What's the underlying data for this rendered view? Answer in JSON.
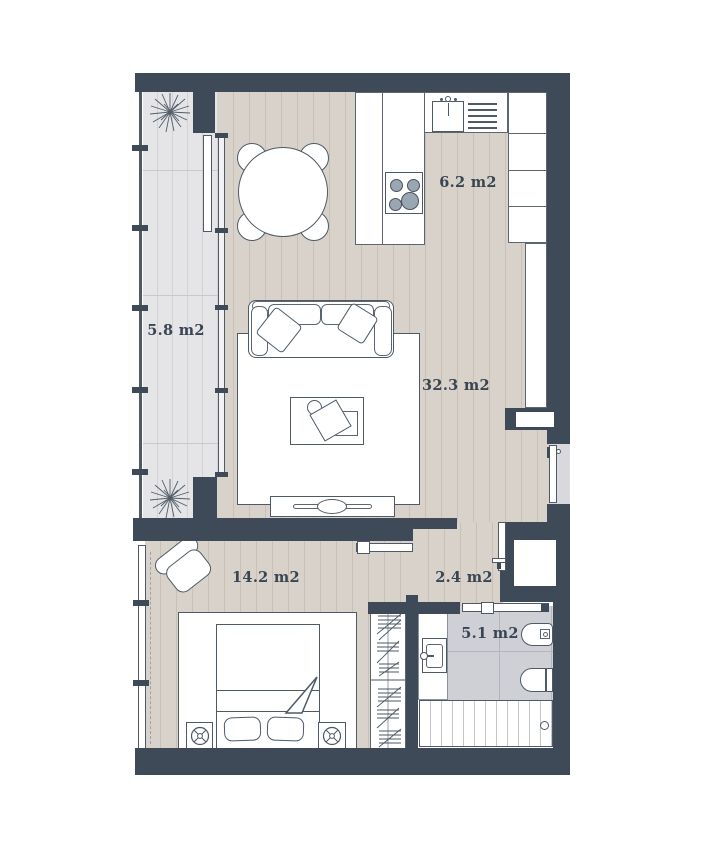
{
  "title": "Apartment floor plan",
  "rooms": [
    {
      "id": "balcony",
      "area_label": "5.8 m2"
    },
    {
      "id": "kitchen",
      "area_label": "6.2 m2"
    },
    {
      "id": "living-room",
      "area_label": "32.3 m2"
    },
    {
      "id": "bedroom",
      "area_label": "14.2 m2"
    },
    {
      "id": "hallway",
      "area_label": "2.4 m2"
    },
    {
      "id": "bathroom",
      "area_label": "5.1 m2"
    }
  ],
  "symbols": [
    "plant-icon",
    "dining-table-icon",
    "dining-chair-icon",
    "kitchen-sink-icon",
    "dish-drainer-icon",
    "stove-icon",
    "cabinet-icon",
    "sofa-icon",
    "throw-pillow-icon",
    "rug-icon",
    "coffee-table-icon",
    "tv-stand-icon",
    "bed-icon",
    "pillow-icon",
    "blanket-fold-icon",
    "nightstand-icon",
    "armchair-icon",
    "wardrobe-icon",
    "washbasin-icon",
    "toilet-icon",
    "bidet-icon",
    "bathtub-icon",
    "entrance-door-icon",
    "door-leaf-icon",
    "sliding-door-icon",
    "window-icon",
    "railing-icon"
  ],
  "colors": {
    "wall": "#3e4a57",
    "wood_floor": "#d9d2ca",
    "wood_line": "#c9c1b8",
    "balcony_floor": "#e5e4e7",
    "tile_floor": "#ced0d6",
    "outline": "#4e5a66",
    "label_text": "#394552",
    "burner_fill": "#9aa7b3",
    "doorway": "#d9d9dd"
  }
}
